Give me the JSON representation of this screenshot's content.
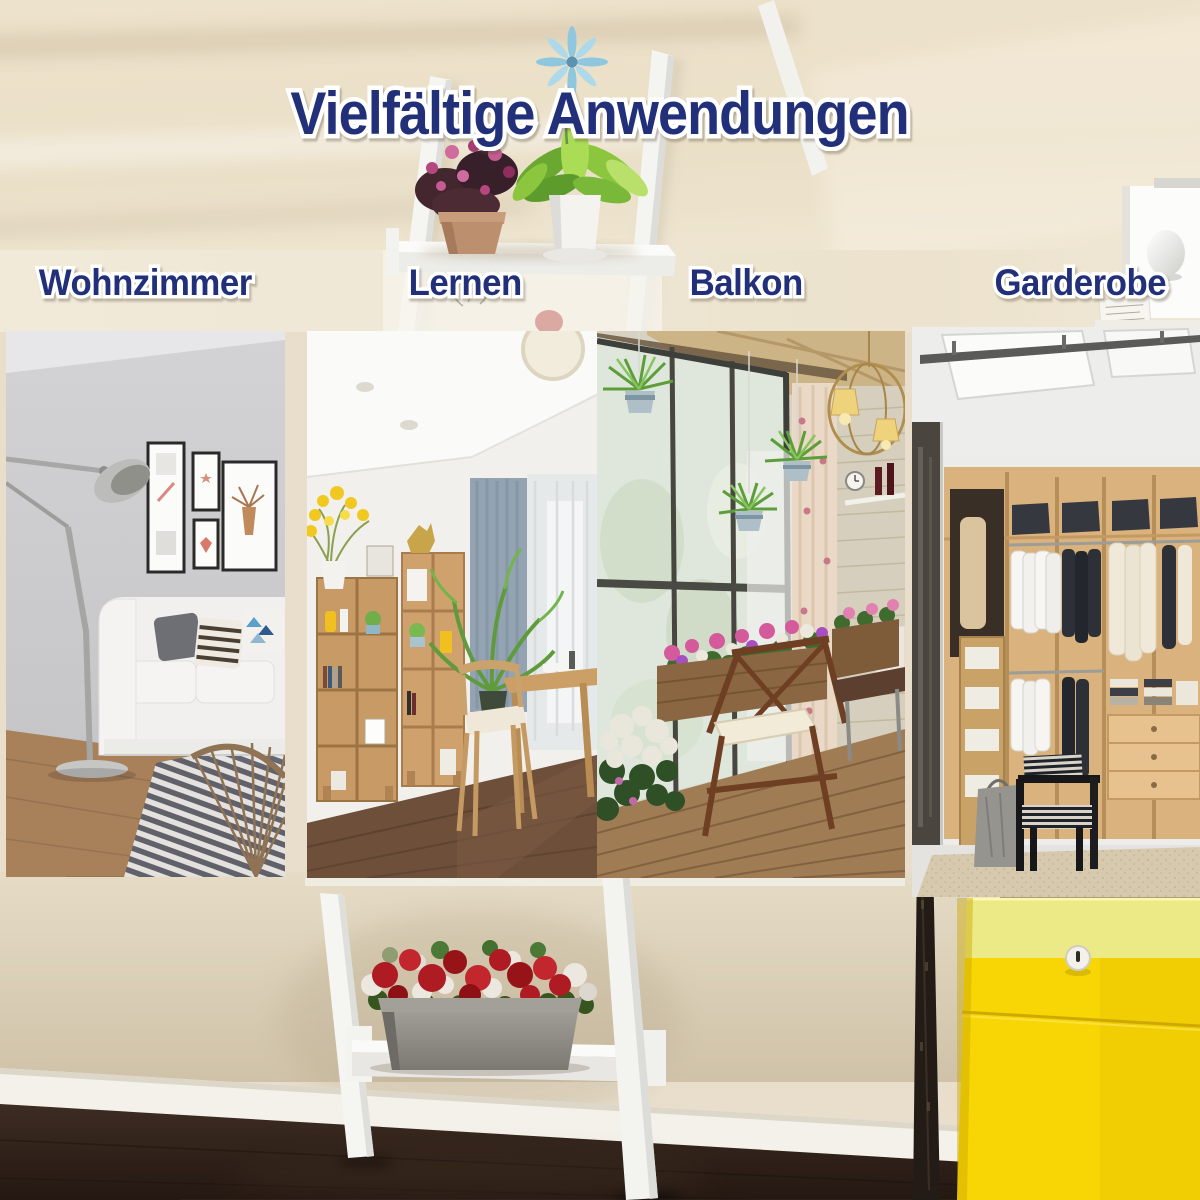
{
  "title": {
    "text": "Vielfältige Anwendungen"
  },
  "sections": [
    {
      "label": "Wohnzimmer"
    },
    {
      "label": "Lernen"
    },
    {
      "label": "Balkon"
    },
    {
      "label": "Garderobe"
    }
  ],
  "colors": {
    "title_navy": "#22307a",
    "outline_white": "#ffffff",
    "wall_cream": "#ece1c9",
    "wall_lower_tan": "#d3c6ae",
    "baseboard_white": "#f3f1ea",
    "floor_espresso": "#2f2119",
    "ladder_white": "#f5f5f2",
    "planter_gray": "#8f8c86",
    "rose_red": "#ae1b22",
    "rose_white": "#ece8e0",
    "cabinet_yellow": "#f8d903",
    "cabinet_pale_yellow": "#eeeb82"
  }
}
